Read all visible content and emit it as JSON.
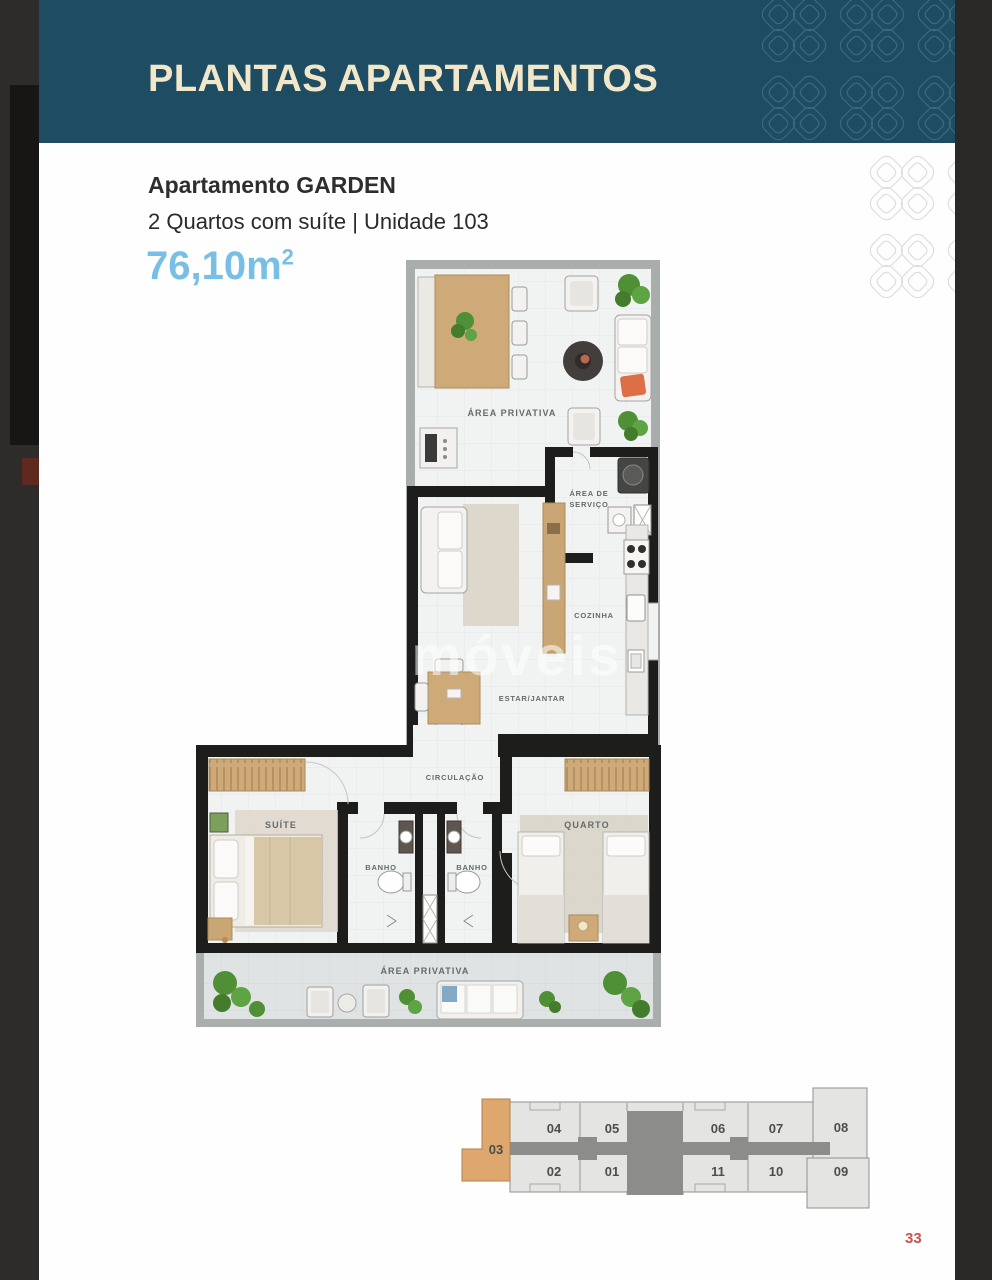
{
  "header": {
    "title": "PLANTAS APARTAMENTOS"
  },
  "apartment": {
    "name": "Apartamento GARDEN",
    "specs": "2 Quartos com suíte | Unidade 103",
    "area": "76,10m",
    "area_sup": "2"
  },
  "floorplan": {
    "watermark": "móveis",
    "labels": {
      "area_privativa_top": "ÁREA PRIVATIVA",
      "area_servico_1": "ÁREA DE",
      "area_servico_2": "SERVIÇO",
      "cozinha": "COZINHA",
      "estar_jantar": "ESTAR/JANTAR",
      "circulacao": "CIRCULAÇÃO",
      "suite": "SUÍTE",
      "banho": "BANHO",
      "quarto": "QUARTO",
      "area_privativa_bottom": "ÁREA PRIVATIVA"
    }
  },
  "keyplan": {
    "highlighted_unit": "03",
    "units_top": [
      "04",
      "05",
      "06",
      "07",
      "08"
    ],
    "units_bottom": [
      "02",
      "01",
      "11",
      "10",
      "09"
    ]
  },
  "footer": {
    "page_number": "33"
  },
  "colors": {
    "header_teal": "#1e4d63",
    "title_cream": "#f2e8c9",
    "area_blue": "#78bfe6",
    "unit_highlight": "#dda76e",
    "page_number_red": "#c7554c"
  }
}
